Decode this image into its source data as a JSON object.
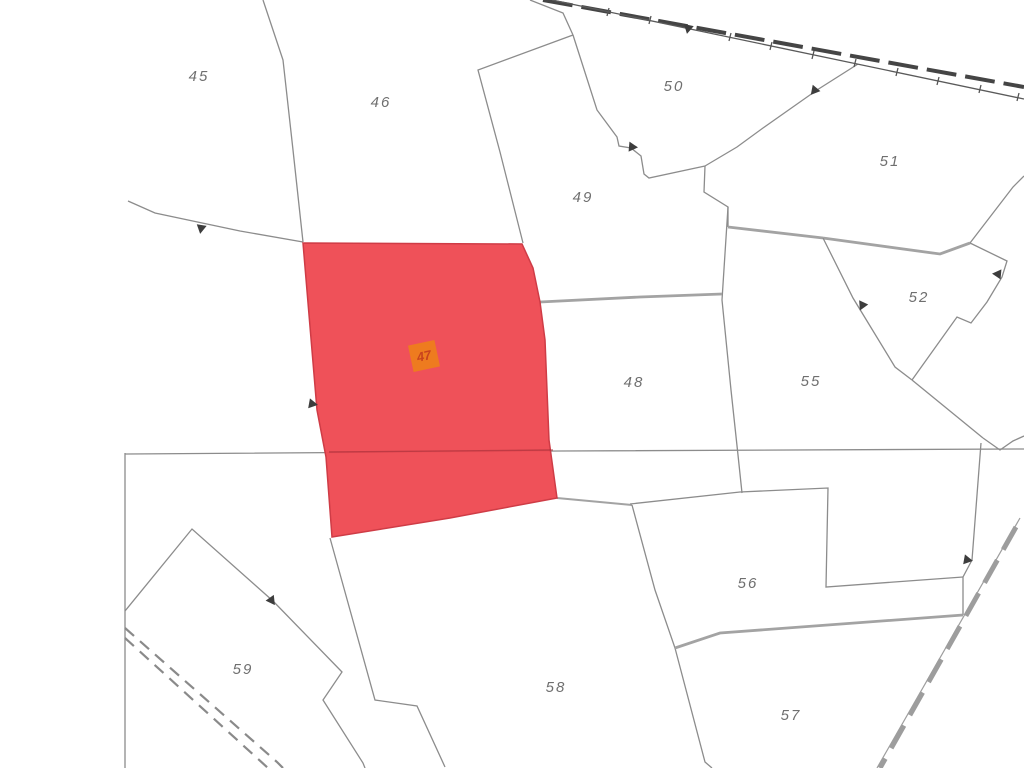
{
  "map": {
    "width": 1024,
    "height": 768,
    "colors": {
      "background": "#ffffff",
      "boundary": "#8c8c8c",
      "shaded_boundary": "#a3a3a3",
      "dark_road": "#454545",
      "light_road": "#9d9d9d",
      "rail_dash": "#8a8a8a",
      "marker": "#3d3d3d",
      "label": "#6f6f6f",
      "highlight_fill": "#ee4a52",
      "highlight_stroke": "#cf3c46",
      "highlight_crossline": "rgba(160,45,55,0.6)",
      "highlight_label_bg": "#ee7b1f",
      "highlight_label_text": "#c8431d"
    },
    "highlight": {
      "id": "47",
      "polygon": [
        [
          303,
          243
        ],
        [
          522,
          244
        ],
        [
          533,
          268
        ],
        [
          540,
          302
        ],
        [
          545,
          340
        ],
        [
          549,
          440
        ],
        [
          557,
          498
        ],
        [
          450,
          518
        ],
        [
          332,
          537
        ],
        [
          326,
          457
        ],
        [
          317,
          410
        ],
        [
          303,
          243
        ]
      ],
      "cross_line": [
        [
          329,
          452
        ],
        [
          553,
          450
        ]
      ],
      "label": {
        "text": "47",
        "x": 424,
        "y": 356,
        "size": 27,
        "rotate": -12,
        "font": 13
      }
    },
    "labels": [
      {
        "id": "45",
        "x": 199,
        "y": 77
      },
      {
        "id": "46",
        "x": 381,
        "y": 103
      },
      {
        "id": "48",
        "x": 634,
        "y": 383
      },
      {
        "id": "49",
        "x": 583,
        "y": 198
      },
      {
        "id": "50",
        "x": 674,
        "y": 87
      },
      {
        "id": "51",
        "x": 890,
        "y": 162
      },
      {
        "id": "52",
        "x": 919,
        "y": 298
      },
      {
        "id": "55",
        "x": 811,
        "y": 382
      },
      {
        "id": "56",
        "x": 748,
        "y": 584
      },
      {
        "id": "57",
        "x": 791,
        "y": 716
      },
      {
        "id": "58",
        "x": 556,
        "y": 688
      },
      {
        "id": "59",
        "x": 243,
        "y": 670
      }
    ],
    "lines": [
      {
        "name": "boundary-45-46",
        "points": [
          [
            263,
            0
          ],
          [
            283,
            60
          ],
          [
            293,
            150
          ],
          [
            303,
            242
          ]
        ],
        "kind": "boundary"
      },
      {
        "name": "boundary-west-45",
        "points": [
          [
            128,
            201
          ],
          [
            155,
            213
          ],
          [
            240,
            231
          ],
          [
            303,
            242
          ]
        ],
        "kind": "boundary"
      },
      {
        "name": "boundary-46-49",
        "points": [
          [
            573,
            35
          ],
          [
            478,
            70
          ],
          [
            500,
            152
          ],
          [
            523,
            243
          ]
        ],
        "kind": "boundary"
      },
      {
        "name": "boundary-46-top",
        "points": [
          [
            530,
            0
          ],
          [
            563,
            13
          ],
          [
            573,
            35
          ]
        ],
        "kind": "boundary"
      },
      {
        "name": "boundary-49-50",
        "points": [
          [
            573,
            35
          ],
          [
            597,
            110
          ],
          [
            617,
            137
          ],
          [
            619,
            146
          ],
          [
            631,
            148
          ],
          [
            641,
            156
          ],
          [
            644,
            174
          ],
          [
            649,
            178
          ],
          [
            705,
            166
          ]
        ],
        "kind": "boundary"
      },
      {
        "name": "boundary-50-51",
        "points": [
          [
            858,
            64
          ],
          [
            817,
            90
          ],
          [
            763,
            128
          ],
          [
            737,
            147
          ],
          [
            705,
            166
          ]
        ],
        "kind": "boundary"
      },
      {
        "name": "boundary-49-51",
        "points": [
          [
            705,
            166
          ],
          [
            704,
            192
          ],
          [
            728,
            207
          ],
          [
            728,
            227
          ]
        ],
        "kind": "boundary"
      },
      {
        "name": "boundary-48-east",
        "points": [
          [
            728,
            207
          ],
          [
            722,
            300
          ],
          [
            731,
            390
          ],
          [
            738,
            455
          ],
          [
            742,
            493
          ]
        ],
        "kind": "boundary"
      },
      {
        "name": "boundary-51-55",
        "points": [
          [
            728,
            227
          ],
          [
            823,
            238
          ]
        ],
        "kind": "shaded"
      },
      {
        "name": "boundary-51-52",
        "points": [
          [
            823,
            238
          ],
          [
            940,
            254
          ],
          [
            970,
            243
          ]
        ],
        "kind": "shaded"
      },
      {
        "name": "boundary-52-ne",
        "points": [
          [
            970,
            243
          ],
          [
            1013,
            187
          ],
          [
            1024,
            176
          ]
        ],
        "kind": "boundary"
      },
      {
        "name": "boundary-52-east",
        "points": [
          [
            970,
            243
          ],
          [
            1007,
            261
          ],
          [
            1002,
            277
          ],
          [
            987,
            302
          ],
          [
            971,
            323
          ],
          [
            957,
            317
          ],
          [
            912,
            380
          ]
        ],
        "kind": "boundary"
      },
      {
        "name": "boundary-52-55",
        "points": [
          [
            823,
            238
          ],
          [
            853,
            298
          ],
          [
            895,
            367
          ],
          [
            912,
            380
          ]
        ],
        "kind": "boundary"
      },
      {
        "name": "boundary-55-se",
        "points": [
          [
            912,
            380
          ],
          [
            983,
            438
          ]
        ],
        "kind": "boundary"
      },
      {
        "name": "boundary-v-notch",
        "points": [
          [
            983,
            438
          ],
          [
            1000,
            450
          ],
          [
            1013,
            441
          ],
          [
            1024,
            436
          ]
        ],
        "kind": "boundary"
      },
      {
        "name": "boundary-56-east",
        "points": [
          [
            981,
            443
          ],
          [
            972,
            560
          ],
          [
            963,
            577
          ],
          [
            963,
            615
          ]
        ],
        "kind": "boundary"
      },
      {
        "name": "boundary-48-49",
        "points": [
          [
            540,
            302
          ],
          [
            640,
            297
          ],
          [
            722,
            294
          ]
        ],
        "kind": "shaded"
      },
      {
        "name": "section-horizontal",
        "points": [
          [
            125,
            454
          ],
          [
            560,
            451
          ],
          [
            1024,
            449
          ]
        ],
        "kind": "boundary"
      },
      {
        "name": "border-west",
        "points": [
          [
            125,
            453
          ],
          [
            125,
            768
          ]
        ],
        "kind": "boundary"
      },
      {
        "name": "parcel-59-outline",
        "points": [
          [
            125,
            611
          ],
          [
            192,
            529
          ],
          [
            273,
            601
          ],
          [
            342,
            672
          ],
          [
            323,
            700
          ],
          [
            363,
            763
          ],
          [
            365,
            768
          ]
        ],
        "kind": "boundary"
      },
      {
        "name": "track-sw-a",
        "points": [
          [
            125,
            628
          ],
          [
            277,
            762
          ],
          [
            283,
            768
          ]
        ],
        "kind": "rail"
      },
      {
        "name": "track-sw-b",
        "points": [
          [
            125,
            638
          ],
          [
            268,
            768
          ]
        ],
        "kind": "rail"
      },
      {
        "name": "boundary-58-west",
        "points": [
          [
            330,
            538
          ],
          [
            375,
            700
          ],
          [
            417,
            706
          ],
          [
            445,
            767
          ]
        ],
        "kind": "boundary"
      },
      {
        "name": "boundary-58-top",
        "points": [
          [
            557,
            498
          ],
          [
            632,
            505
          ]
        ],
        "kind": "shaded-thin"
      },
      {
        "name": "boundary-58-east",
        "points": [
          [
            632,
            505
          ],
          [
            655,
            590
          ],
          [
            675,
            648
          ]
        ],
        "kind": "boundary"
      },
      {
        "name": "boundary-57-58",
        "points": [
          [
            675,
            648
          ],
          [
            705,
            762
          ],
          [
            712,
            768
          ]
        ],
        "kind": "boundary"
      },
      {
        "name": "boundary-56-south",
        "points": [
          [
            675,
            648
          ],
          [
            720,
            633
          ],
          [
            963,
            615
          ]
        ],
        "kind": "shaded"
      },
      {
        "name": "boundary-56-stairs",
        "points": [
          [
            630,
            504
          ],
          [
            740,
            492
          ],
          [
            828,
            488
          ],
          [
            826,
            587
          ],
          [
            963,
            577
          ]
        ],
        "kind": "boundary"
      },
      {
        "name": "road-se-edge",
        "points": [
          [
            1020,
            518
          ],
          [
            877,
            768
          ]
        ],
        "kind": "thin-road"
      },
      {
        "name": "road-se-dashes",
        "points": [
          [
            1016,
            527
          ],
          [
            880,
            768
          ]
        ],
        "kind": "gray-dash-road"
      },
      {
        "name": "road-ne-dashes",
        "points": [
          [
            543,
            0
          ],
          [
            1024,
            87
          ]
        ],
        "kind": "dark-dash-road"
      },
      {
        "name": "road-ne-edge",
        "points": [
          [
            552,
            0
          ],
          [
            1024,
            99
          ]
        ],
        "kind": "tick-line"
      }
    ],
    "ticks": [
      {
        "x": 608,
        "y": 12
      },
      {
        "x": 650,
        "y": 20
      },
      {
        "x": 730,
        "y": 37
      },
      {
        "x": 771,
        "y": 46
      },
      {
        "x": 813,
        "y": 55
      },
      {
        "x": 855,
        "y": 63
      },
      {
        "x": 897,
        "y": 72
      },
      {
        "x": 938,
        "y": 81
      },
      {
        "x": 980,
        "y": 89
      },
      {
        "x": 1018,
        "y": 97
      }
    ],
    "markers": [
      {
        "x": 201,
        "y": 229,
        "rot": 10
      },
      {
        "x": 688,
        "y": 29,
        "rot": 12
      },
      {
        "x": 814,
        "y": 91,
        "rot": 40
      },
      {
        "x": 633,
        "y": 147,
        "rot": -85
      },
      {
        "x": 313,
        "y": 404,
        "rot": -80
      },
      {
        "x": 862,
        "y": 306,
        "rot": 25
      },
      {
        "x": 997,
        "y": 274,
        "rot": 95
      },
      {
        "x": 272,
        "y": 601,
        "rot": -35
      },
      {
        "x": 968,
        "y": 560,
        "rot": -80
      }
    ]
  }
}
